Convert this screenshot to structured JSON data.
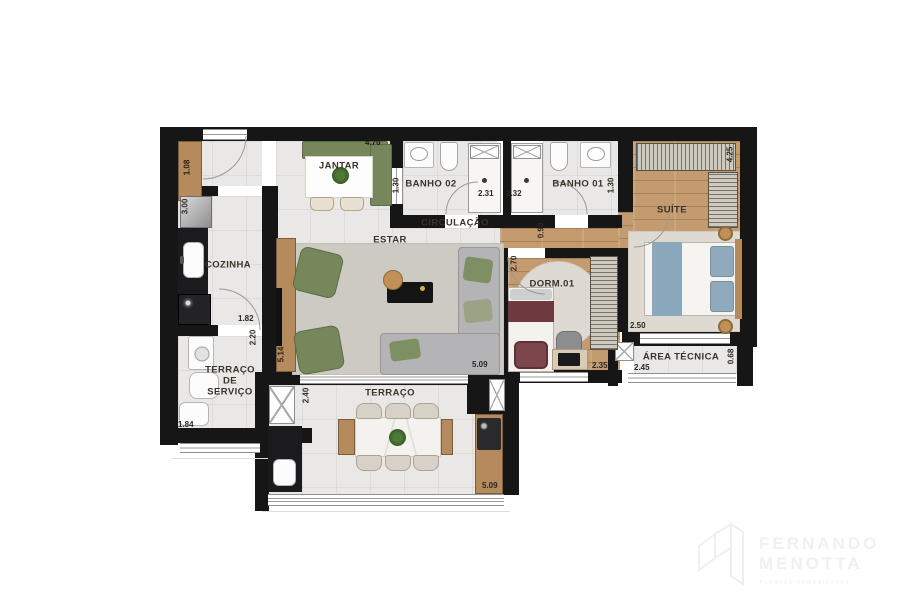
{
  "rooms": {
    "jantar": "JANTAR",
    "banho02": "BANHO 02",
    "banho01": "BANHO 01",
    "suite": "SUÍTE",
    "circulacao": "CIRCULAÇÃO",
    "estar": "ESTAR",
    "cozinha": "COZINHA",
    "dorm01": "DORM.01",
    "area_tecnica": "ÁREA TÉCNICA",
    "terraco": "TERRAÇO",
    "terraco_servico": {
      "l1": "TERRAÇO",
      "l2": "DE",
      "l3": "SERVIÇO"
    }
  },
  "dims": {
    "entry_cabinet": "1.08",
    "cozinha_top": "3.00",
    "jantar_top": "4.70",
    "banho02_left": "1.30",
    "banho02_bottom": "2.31",
    "banho01_bottom": "2.32",
    "banho01_right": "1.30",
    "suite_right": "4.25",
    "dorm_door": "0.90",
    "dorm_left": "2.70",
    "cozinha_bottom": "1.82",
    "cozinha_wall": "2.20",
    "estar_left": "5.14",
    "suite_bottom": "2.50",
    "dorm_bottom": "2.35",
    "area_tecnica_bottom": "2.45",
    "area_tecnica_right": "0.68",
    "servico_bottom": "1.84",
    "terraco_left": "2.40",
    "estar_bottom": "5.09",
    "terraco_bottom": "5.09"
  },
  "watermark": {
    "name_line1": "FERNANDO",
    "name_line2": "MENOTTA",
    "tagline": "PLANTAS HUMANIZADAS"
  },
  "colors": {
    "wall": "#161616",
    "tile_floor": "#e9e8e6",
    "wood_floor": "#c49b6f",
    "furniture_green": "#76875c",
    "sofa_gray": "#b4b4b6",
    "bed_blue": "#8ba7bb",
    "bed_maroon": "#6e3a40",
    "counter_black": "#1b1b1d",
    "wardrobe_hatch": "#cfcabf",
    "marble": "#f2f0ed"
  }
}
